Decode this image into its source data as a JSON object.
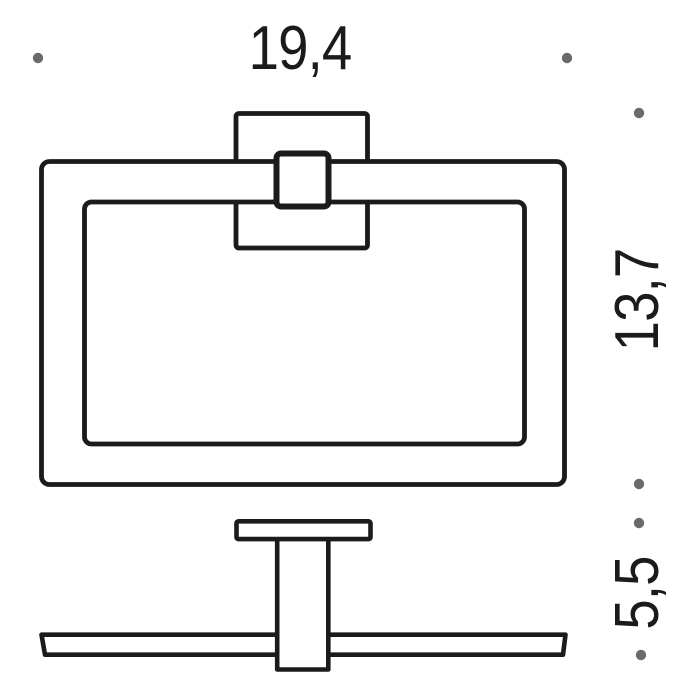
{
  "diagram": {
    "kind": "technical-dimension-drawing",
    "subject": "wall-mounted towel ring, front view and side view",
    "labels": {
      "width": "19,4",
      "height": "13,7",
      "depth": "5,5"
    },
    "colors": {
      "line": "#1b1b1b",
      "text": "#1b1b1b",
      "watermark_dot": "#6a6a6a",
      "background": "#ffffff"
    }
  }
}
